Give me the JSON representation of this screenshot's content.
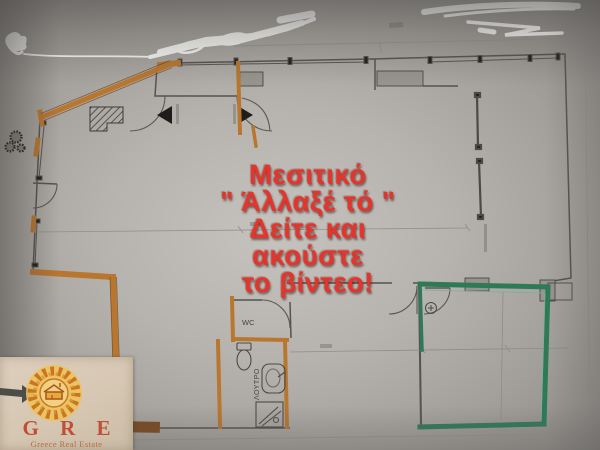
{
  "overlay": {
    "lines": [
      "Μεσιτικό",
      "\" Άλλαξέ τό \"",
      "Δείτε και",
      "ακούστε",
      "το βίντεο!"
    ],
    "text_color": "#e5342b"
  },
  "logo": {
    "acronym": "G R E",
    "tagline": "Greece Real Estate",
    "text_color": "#c24f35"
  },
  "plan": {
    "labels": {
      "wc": "WC",
      "bathroom": "ΛΟΥΤΡΟ"
    },
    "colors": {
      "highlight_orange": "#b9762f",
      "highlight_green": "#2e7a57",
      "wall_line": "#55534e",
      "paper": "#b6b3ae"
    }
  }
}
